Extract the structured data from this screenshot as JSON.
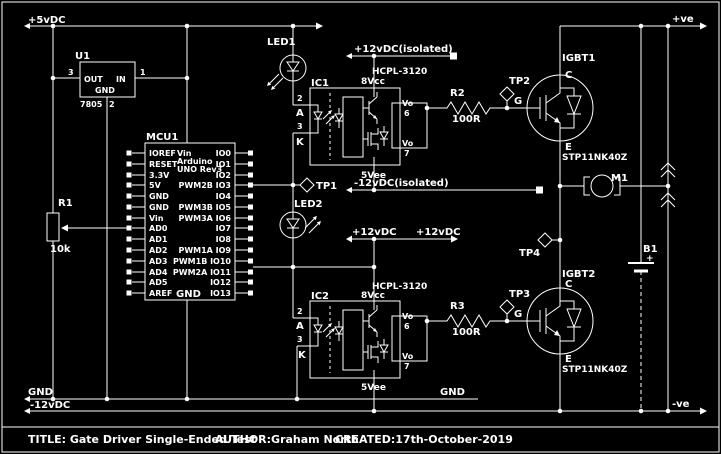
{
  "power": {
    "p5": "+5vDC",
    "p12iso": "+12vDC(isolated)",
    "n12iso": "-12vDC(isolated)",
    "p12a": "+12vDC",
    "p12b": "+12vDC",
    "gnd1": "GND",
    "gnd2": "GND",
    "n12": "-12vDC",
    "pos": "+ve",
    "neg": "-ve"
  },
  "u1": {
    "ref": "U1",
    "value": "7805",
    "out": "OUT",
    "in": "IN",
    "gnd": "GND",
    "pin1": "1",
    "pin2": "2",
    "pin3": "3"
  },
  "mcu": {
    "ref": "MCU1",
    "top": "Vin",
    "brand": "Arduino",
    "model": "UNO Rev3",
    "gnd": "GND",
    "left": [
      "IOREF",
      "RESET",
      "3.3V",
      "5V",
      "GND",
      "GND",
      "Vin",
      "AD0",
      "AD1",
      "AD2",
      "AD3",
      "AD4",
      "AD5",
      "AREF"
    ],
    "right": [
      "IO0",
      "IO1",
      "IO2",
      "PWM2B IO3",
      "IO4",
      "PWM3B IO5",
      "PWM3A IO6",
      "IO7",
      "IO8",
      "PWM1A IO9",
      "PWM1B IO10",
      "PWM2A IO11",
      "IO12",
      "IO13"
    ]
  },
  "r1": {
    "ref": "R1",
    "value": "10k"
  },
  "r2": {
    "ref": "R2",
    "value": "100R"
  },
  "r3": {
    "ref": "R3",
    "value": "100R"
  },
  "led1": {
    "ref": "LED1"
  },
  "led2": {
    "ref": "LED2"
  },
  "ic1": {
    "ref": "IC1",
    "part": "HCPL-3120",
    "vcc": "8Vcc",
    "vee": "5Vee",
    "a_pin": "2",
    "a": "A",
    "k_pin": "3",
    "k": "K",
    "vo1": "Vo",
    "vo1_pin": "6",
    "vo2": "Vo",
    "vo2_pin": "7"
  },
  "ic2": {
    "ref": "IC2",
    "part": "HCPL-3120",
    "vcc": "8Vcc",
    "vee": "5Vee",
    "a_pin": "2",
    "a": "A",
    "k_pin": "3",
    "k": "K",
    "vo1": "Vo",
    "vo1_pin": "6",
    "vo2": "Vo",
    "vo2_pin": "7"
  },
  "igbt1": {
    "ref": "IGBT1",
    "part": "STP11NK40Z",
    "c": "C",
    "g": "G",
    "e": "E"
  },
  "igbt2": {
    "ref": "IGBT2",
    "part": "STP11NK40Z",
    "c": "C",
    "g": "G",
    "e": "E"
  },
  "m1": {
    "ref": "M1"
  },
  "b1": {
    "ref": "B1",
    "plus": "+"
  },
  "tp1": {
    "ref": "TP1"
  },
  "tp2": {
    "ref": "TP2"
  },
  "tp3": {
    "ref": "TP3"
  },
  "tp4": {
    "ref": "TP4"
  },
  "title_block": {
    "title": "TITLE: Gate Driver Single-Ended Test",
    "author": "AUTHOR:Graham North",
    "created": "CREATED:17th-October-2019"
  }
}
